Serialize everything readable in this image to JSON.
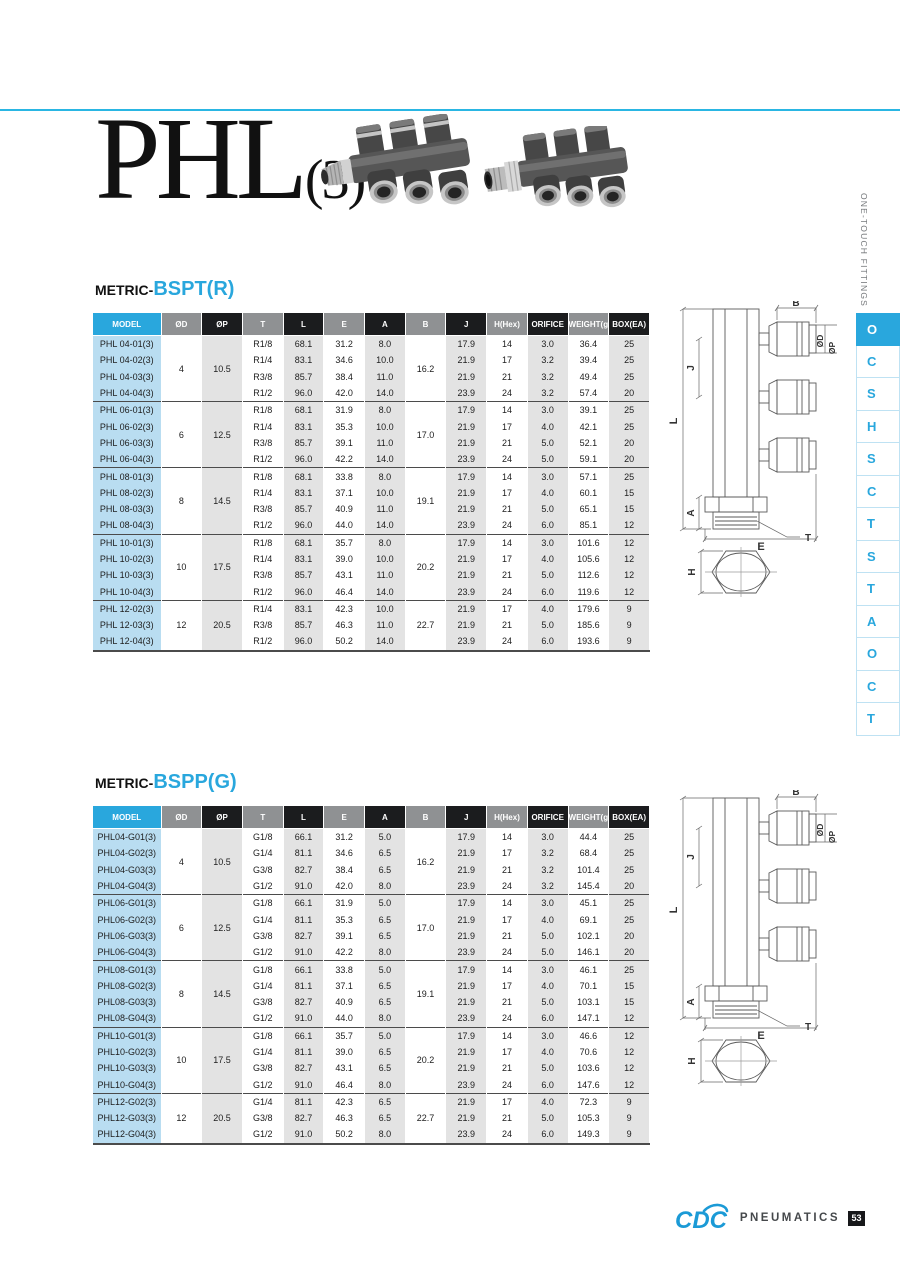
{
  "page": {
    "title_main": "PHL",
    "title_sub": "(3)"
  },
  "sidebar": {
    "vertical_label": "ONE-TOUCH FITTINGS",
    "tabs": [
      "O",
      "C",
      "S",
      "H",
      "S",
      "C",
      "T",
      "S",
      "T",
      "A",
      "O",
      "C",
      "T"
    ],
    "active_tab_index": 0
  },
  "footer": {
    "logo": "CDC",
    "brand": "PNEUMATICS",
    "page_number": "53"
  },
  "diagram": {
    "labels": {
      "b": "B",
      "od": "ØD",
      "op": "ØP",
      "j": "J",
      "l": "L",
      "a": "A",
      "t": "T",
      "e": "E",
      "h": "H"
    }
  },
  "tables": [
    {
      "section_prefix": "METRIC-",
      "section_name": "BSPT(R)",
      "headers": [
        "MODEL",
        "ØD",
        "ØP",
        "T",
        "L",
        "E",
        "A",
        "B",
        "J",
        "H(Hex)",
        "ORIFICE",
        "WEIGHT(g)",
        "BOX(EA)"
      ],
      "groups": [
        {
          "od": "4",
          "op": "10.5",
          "b": "16.2",
          "rows": [
            [
              "PHL 04-01(3)",
              "R1/8",
              "68.1",
              "31.2",
              "8.0",
              "17.9",
              "14",
              "3.0",
              "36.4",
              "25"
            ],
            [
              "PHL 04-02(3)",
              "R1/4",
              "83.1",
              "34.6",
              "10.0",
              "21.9",
              "17",
              "3.2",
              "39.4",
              "25"
            ],
            [
              "PHL 04-03(3)",
              "R3/8",
              "85.7",
              "38.4",
              "11.0",
              "21.9",
              "21",
              "3.2",
              "49.4",
              "25"
            ],
            [
              "PHL 04-04(3)",
              "R1/2",
              "96.0",
              "42.0",
              "14.0",
              "23.9",
              "24",
              "3.2",
              "57.4",
              "20"
            ]
          ]
        },
        {
          "od": "6",
          "op": "12.5",
          "b": "17.0",
          "rows": [
            [
              "PHL 06-01(3)",
              "R1/8",
              "68.1",
              "31.9",
              "8.0",
              "17.9",
              "14",
              "3.0",
              "39.1",
              "25"
            ],
            [
              "PHL 06-02(3)",
              "R1/4",
              "83.1",
              "35.3",
              "10.0",
              "21.9",
              "17",
              "4.0",
              "42.1",
              "25"
            ],
            [
              "PHL 06-03(3)",
              "R3/8",
              "85.7",
              "39.1",
              "11.0",
              "21.9",
              "21",
              "5.0",
              "52.1",
              "20"
            ],
            [
              "PHL 06-04(3)",
              "R1/2",
              "96.0",
              "42.2",
              "14.0",
              "23.9",
              "24",
              "5.0",
              "59.1",
              "20"
            ]
          ]
        },
        {
          "od": "8",
          "op": "14.5",
          "b": "19.1",
          "rows": [
            [
              "PHL 08-01(3)",
              "R1/8",
              "68.1",
              "33.8",
              "8.0",
              "17.9",
              "14",
              "3.0",
              "57.1",
              "25"
            ],
            [
              "PHL 08-02(3)",
              "R1/4",
              "83.1",
              "37.1",
              "10.0",
              "21.9",
              "17",
              "4.0",
              "60.1",
              "15"
            ],
            [
              "PHL 08-03(3)",
              "R3/8",
              "85.7",
              "40.9",
              "11.0",
              "21.9",
              "21",
              "5.0",
              "65.1",
              "15"
            ],
            [
              "PHL 08-04(3)",
              "R1/2",
              "96.0",
              "44.0",
              "14.0",
              "23.9",
              "24",
              "6.0",
              "85.1",
              "12"
            ]
          ]
        },
        {
          "od": "10",
          "op": "17.5",
          "b": "20.2",
          "rows": [
            [
              "PHL 10-01(3)",
              "R1/8",
              "68.1",
              "35.7",
              "8.0",
              "17.9",
              "14",
              "3.0",
              "101.6",
              "12"
            ],
            [
              "PHL 10-02(3)",
              "R1/4",
              "83.1",
              "39.0",
              "10.0",
              "21.9",
              "17",
              "4.0",
              "105.6",
              "12"
            ],
            [
              "PHL 10-03(3)",
              "R3/8",
              "85.7",
              "43.1",
              "11.0",
              "21.9",
              "21",
              "5.0",
              "112.6",
              "12"
            ],
            [
              "PHL 10-04(3)",
              "R1/2",
              "96.0",
              "46.4",
              "14.0",
              "23.9",
              "24",
              "6.0",
              "119.6",
              "12"
            ]
          ]
        },
        {
          "od": "12",
          "op": "20.5",
          "b": "22.7",
          "rows": [
            [
              "PHL 12-02(3)",
              "R1/4",
              "83.1",
              "42.3",
              "10.0",
              "21.9",
              "17",
              "4.0",
              "179.6",
              "9"
            ],
            [
              "PHL 12-03(3)",
              "R3/8",
              "85.7",
              "46.3",
              "11.0",
              "21.9",
              "21",
              "5.0",
              "185.6",
              "9"
            ],
            [
              "PHL 12-04(3)",
              "R1/2",
              "96.0",
              "50.2",
              "14.0",
              "23.9",
              "24",
              "6.0",
              "193.6",
              "9"
            ]
          ]
        }
      ]
    },
    {
      "section_prefix": "METRIC-",
      "section_name": "BSPP(G)",
      "headers": [
        "MODEL",
        "ØD",
        "ØP",
        "T",
        "L",
        "E",
        "A",
        "B",
        "J",
        "H(Hex)",
        "ORIFICE",
        "WEIGHT(g)",
        "BOX(EA)"
      ],
      "groups": [
        {
          "od": "4",
          "op": "10.5",
          "b": "16.2",
          "rows": [
            [
              "PHL04-G01(3)",
              "G1/8",
              "66.1",
              "31.2",
              "5.0",
              "17.9",
              "14",
              "3.0",
              "44.4",
              "25"
            ],
            [
              "PHL04-G02(3)",
              "G1/4",
              "81.1",
              "34.6",
              "6.5",
              "21.9",
              "17",
              "3.2",
              "68.4",
              "25"
            ],
            [
              "PHL04-G03(3)",
              "G3/8",
              "82.7",
              "38.4",
              "6.5",
              "21.9",
              "21",
              "3.2",
              "101.4",
              "25"
            ],
            [
              "PHL04-G04(3)",
              "G1/2",
              "91.0",
              "42.0",
              "8.0",
              "23.9",
              "24",
              "3.2",
              "145.4",
              "20"
            ]
          ]
        },
        {
          "od": "6",
          "op": "12.5",
          "b": "17.0",
          "rows": [
            [
              "PHL06-G01(3)",
              "G1/8",
              "66.1",
              "31.9",
              "5.0",
              "17.9",
              "14",
              "3.0",
              "45.1",
              "25"
            ],
            [
              "PHL06-G02(3)",
              "G1/4",
              "81.1",
              "35.3",
              "6.5",
              "21.9",
              "17",
              "4.0",
              "69.1",
              "25"
            ],
            [
              "PHL06-G03(3)",
              "G3/8",
              "82.7",
              "39.1",
              "6.5",
              "21.9",
              "21",
              "5.0",
              "102.1",
              "20"
            ],
            [
              "PHL06-G04(3)",
              "G1/2",
              "91.0",
              "42.2",
              "8.0",
              "23.9",
              "24",
              "5.0",
              "146.1",
              "20"
            ]
          ]
        },
        {
          "od": "8",
          "op": "14.5",
          "b": "19.1",
          "rows": [
            [
              "PHL08-G01(3)",
              "G1/8",
              "66.1",
              "33.8",
              "5.0",
              "17.9",
              "14",
              "3.0",
              "46.1",
              "25"
            ],
            [
              "PHL08-G02(3)",
              "G1/4",
              "81.1",
              "37.1",
              "6.5",
              "21.9",
              "17",
              "4.0",
              "70.1",
              "15"
            ],
            [
              "PHL08-G03(3)",
              "G3/8",
              "82.7",
              "40.9",
              "6.5",
              "21.9",
              "21",
              "5.0",
              "103.1",
              "15"
            ],
            [
              "PHL08-G04(3)",
              "G1/2",
              "91.0",
              "44.0",
              "8.0",
              "23.9",
              "24",
              "6.0",
              "147.1",
              "12"
            ]
          ]
        },
        {
          "od": "10",
          "op": "17.5",
          "b": "20.2",
          "rows": [
            [
              "PHL10-G01(3)",
              "G1/8",
              "66.1",
              "35.7",
              "5.0",
              "17.9",
              "14",
              "3.0",
              "46.6",
              "12"
            ],
            [
              "PHL10-G02(3)",
              "G1/4",
              "81.1",
              "39.0",
              "6.5",
              "21.9",
              "17",
              "4.0",
              "70.6",
              "12"
            ],
            [
              "PHL10-G03(3)",
              "G3/8",
              "82.7",
              "43.1",
              "6.5",
              "21.9",
              "21",
              "5.0",
              "103.6",
              "12"
            ],
            [
              "PHL10-G04(3)",
              "G1/2",
              "91.0",
              "46.4",
              "8.0",
              "23.9",
              "24",
              "6.0",
              "147.6",
              "12"
            ]
          ]
        },
        {
          "od": "12",
          "op": "20.5",
          "b": "22.7",
          "rows": [
            [
              "PHL12-G02(3)",
              "G1/4",
              "81.1",
              "42.3",
              "6.5",
              "21.9",
              "17",
              "4.0",
              "72.3",
              "9"
            ],
            [
              "PHL12-G03(3)",
              "G3/8",
              "82.7",
              "46.3",
              "6.5",
              "21.9",
              "21",
              "5.0",
              "105.3",
              "9"
            ],
            [
              "PHL12-G04(3)",
              "G1/2",
              "91.0",
              "50.2",
              "8.0",
              "23.9",
              "24",
              "6.0",
              "149.3",
              "9"
            ]
          ]
        }
      ]
    }
  ]
}
